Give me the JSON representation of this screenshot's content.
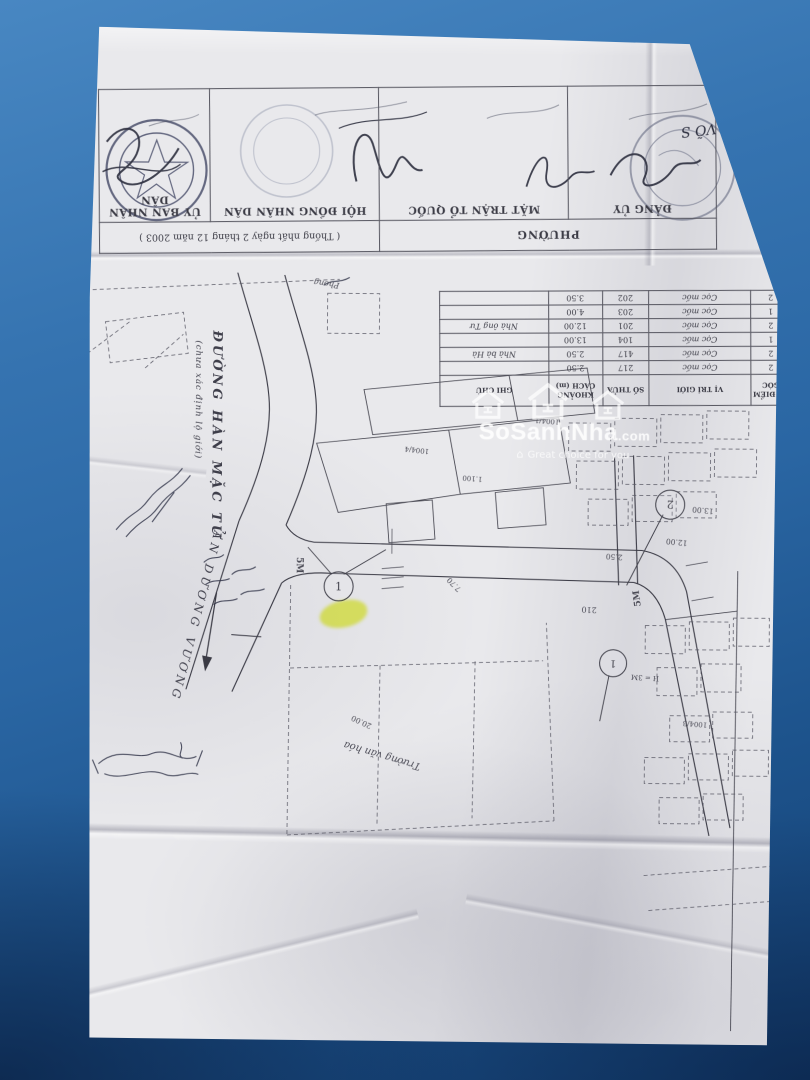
{
  "photo": {
    "background_top_color": "#4887c2",
    "background_bottom_color": "#143f72",
    "paper_color": "#e9e9ec",
    "highlight_color": "#eaf542",
    "ink_color": "#3b3b45"
  },
  "watermark": {
    "brand": "SoSanhNha",
    "domain": ".com",
    "tagline": "Great choice for you",
    "icons": {
      "logo": "three-house-outline",
      "tagline_glyph": "⌂"
    }
  },
  "approval_block": {
    "header_left": "PHƯỜNG",
    "header_right": "( Thống nhất ngày 2 tháng 12 năm 2003 )",
    "cells": [
      {
        "title": "ĐẢNG ỦY"
      },
      {
        "title": "MẶT TRẬN TỔ QUỐC"
      },
      {
        "title": "HỘI ĐỒNG NHÂN DÂN"
      },
      {
        "title": "ỦY BAN NHÂN DÂN"
      }
    ],
    "signer": "VÕ S"
  },
  "boundary_table": {
    "headers": [
      "SỐ ĐIỂM GÓC",
      "VỊ TRÍ GIỚI",
      "SỐ THỬA",
      "KHOẢNG CÁCH (m)",
      "GHI CHÚ"
    ],
    "rows": [
      {
        "diem": "2",
        "vi_tri": "Cọc mốc",
        "so_thua": "217",
        "khoang_cach": "2.50",
        "ghi_chu": ""
      },
      {
        "diem": "2",
        "vi_tri": "Cọc mốc",
        "so_thua": "417",
        "khoang_cach": "2.50",
        "ghi_chu": "Nhà bà Hà"
      },
      {
        "diem": "1",
        "vi_tri": "Cọc mốc",
        "so_thua": "104",
        "khoang_cach": "13.00",
        "ghi_chu": ""
      },
      {
        "diem": "2",
        "vi_tri": "Cọc mốc",
        "so_thua": "201",
        "khoang_cach": "12.00",
        "ghi_chu": "Nhà ông Tư"
      },
      {
        "diem": "1",
        "vi_tri": "Cọc mốc",
        "so_thua": "203",
        "khoang_cach": "4.00",
        "ghi_chu": ""
      },
      {
        "diem": "2",
        "vi_tri": "Cọc mốc",
        "so_thua": "202",
        "khoang_cach": "3.50",
        "ghi_chu": ""
      }
    ]
  },
  "map": {
    "street_han_mac_tu": "ĐƯỜNG HÀN MẶC TỬ",
    "street_han_mac_tu_note": "(chưa xác định lộ giới)",
    "street_an_duong_vuong": "AN DƯƠNG VƯƠNG",
    "building_label": "Trường văn hóa",
    "area_label": "Phong",
    "markers": [
      {
        "n": "1"
      },
      {
        "n": "2"
      },
      {
        "n": "1"
      }
    ],
    "labels": [
      {
        "t": "5M"
      },
      {
        "t": "5M"
      },
      {
        "t": "7.70"
      },
      {
        "t": "12.00"
      },
      {
        "t": "13.00"
      },
      {
        "t": "2.50"
      },
      {
        "t": "210"
      },
      {
        "t": "1004/1"
      },
      {
        "t": "1004/4"
      },
      {
        "t": "1.100"
      },
      {
        "t": "H = 3M"
      },
      {
        "t": "20.00"
      },
      {
        "t": "1004/3"
      }
    ]
  }
}
